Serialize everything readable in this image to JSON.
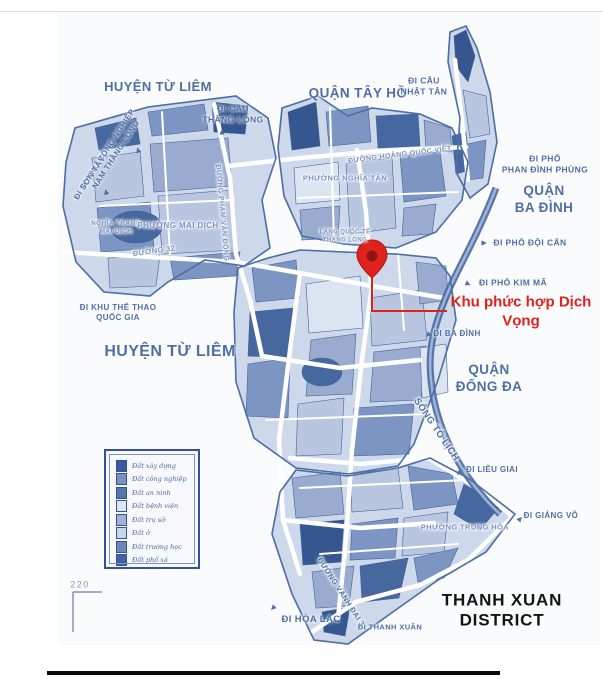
{
  "map": {
    "colors": {
      "label_blue": "#4d6fa6",
      "label_light_blue": "#7b92c0",
      "accent_red": "#df221c",
      "ink_black": "#131313",
      "map_outline": "#4e6fa6",
      "river_blue": "#47679f"
    },
    "highlight": {
      "label": "Khu phức hợp Dịch Vọng",
      "color": "#df221c"
    },
    "scale_label": "220",
    "labels": [
      {
        "name": "label-huyen-tu-liem-top",
        "lines": [
          "HUYỆN TỪ LIÊM"
        ],
        "x": 158,
        "y": 87,
        "fs": 13
      },
      {
        "name": "label-di-cau-thang-long",
        "lines": [
          "ĐI CẦU",
          "THĂNG LONG"
        ],
        "x": 233,
        "y": 114,
        "fs": 8.5
      },
      {
        "name": "label-quan-tay-ho",
        "lines": [
          "QUẬN TÂY HỒ"
        ],
        "x": 358,
        "y": 94,
        "fs": 13.5
      },
      {
        "name": "label-di-cau-nhat-tan",
        "lines": [
          "ĐI CẦU",
          "NHẬT TÂN"
        ],
        "x": 424,
        "y": 86,
        "fs": 8.5
      },
      {
        "name": "label-di-khu-cong-nghiep-nam-thang-long",
        "lines": [
          "ĐI KHU CÔNG NGHIỆP",
          "NAM THĂNG LONG"
        ],
        "x": 112,
        "y": 152,
        "fs": 8,
        "rot": -57
      },
      {
        "name": "label-di-son-tay",
        "lines": [
          "ĐI SƠN TÂY"
        ],
        "x": 90,
        "y": 178,
        "fs": 8,
        "rot": -57
      },
      {
        "name": "label-duong-hoang-quoc-viet",
        "lines": [
          "ĐƯỜNG HOÀNG QUỐC VIỆT"
        ],
        "x": 400,
        "y": 156,
        "fs": 7,
        "rot": -7,
        "cls": "lt halo"
      },
      {
        "name": "label-di-pho-phan-dinh-phung",
        "lines": [
          "ĐI PHỐ",
          "PHAN ĐÌNH PHÙNG"
        ],
        "x": 545,
        "y": 164,
        "fs": 8.5
      },
      {
        "name": "label-quan-ba-dinh",
        "lines": [
          "QUẬN",
          "BA ĐÌNH"
        ],
        "x": 544,
        "y": 200,
        "fs": 13.5
      },
      {
        "name": "label-phuong-nghia-tan",
        "lines": [
          "PHƯỜNG NGHĨA TÂN"
        ],
        "x": 345,
        "y": 178,
        "fs": 7.5,
        "cls": "lt halo"
      },
      {
        "name": "label-nghia-trang-mai-dich",
        "lines": [
          "NGHĨA TRANG",
          "MAI DỊCH"
        ],
        "x": 116,
        "y": 228,
        "fs": 6.5,
        "cls": "lt halo"
      },
      {
        "name": "label-phuong-mai-dich",
        "lines": [
          "PHƯỜNG MAI DỊCH"
        ],
        "x": 178,
        "y": 226,
        "fs": 8,
        "cls": "lt halo"
      },
      {
        "name": "label-duong-32",
        "lines": [
          "ĐƯỜNG 32"
        ],
        "x": 154,
        "y": 251,
        "fs": 7.5,
        "rot": -8,
        "cls": "lt halo"
      },
      {
        "name": "label-duong-pham-van-dong",
        "lines": [
          "ĐƯỜNG PHẠM VĂN ĐỒNG"
        ],
        "x": 221,
        "y": 213,
        "fs": 7,
        "rot": 85,
        "cls": "lt halo"
      },
      {
        "name": "label-lang-quoc-te-thang-long",
        "lines": [
          "LÀNG QUỐC TẾ",
          "THĂNG LONG"
        ],
        "x": 345,
        "y": 237,
        "fs": 6,
        "cls": "lt halo"
      },
      {
        "name": "label-di-pho-doi-can",
        "lines": [
          "ĐI PHỐ ĐỘI CẤN"
        ],
        "x": 530,
        "y": 243,
        "fs": 8.5
      },
      {
        "name": "label-di-pho-kim-ma",
        "lines": [
          "ĐI PHỐ KIM MÃ"
        ],
        "x": 513,
        "y": 283,
        "fs": 8.5
      },
      {
        "name": "label-di-khu-the-thao-quoc-gia",
        "lines": [
          "ĐI KHU THỂ THAO",
          "QUỐC GIA"
        ],
        "x": 118,
        "y": 313,
        "fs": 8
      },
      {
        "name": "label-huyen-tu-liem",
        "lines": [
          "HUYỆN TỪ LIÊM"
        ],
        "x": 170,
        "y": 352,
        "fs": 16
      },
      {
        "name": "label-di-ba-dinh",
        "lines": [
          "ĐI BA ĐÌNH"
        ],
        "x": 457,
        "y": 334,
        "fs": 8
      },
      {
        "name": "label-quan-dong-da",
        "lines": [
          "QUẬN",
          "ĐỐNG ĐA"
        ],
        "x": 489,
        "y": 379,
        "fs": 13.5
      },
      {
        "name": "label-song-to-lich",
        "lines": [
          "SÔNG TÔ LỊCH"
        ],
        "x": 436,
        "y": 430,
        "fs": 9.5,
        "rot": 56,
        "cls": "halo"
      },
      {
        "name": "label-di-lieu-giai",
        "lines": [
          "ĐI LIỄU GIAI"
        ],
        "x": 492,
        "y": 470,
        "fs": 8
      },
      {
        "name": "label-di-giang-vo",
        "lines": [
          "ĐI GIẢNG VÕ"
        ],
        "x": 551,
        "y": 516,
        "fs": 8
      },
      {
        "name": "label-phuong-trung-hoa",
        "lines": [
          "PHƯỜNG TRUNG HÒA"
        ],
        "x": 465,
        "y": 527,
        "fs": 7.5,
        "cls": "lt halo"
      },
      {
        "name": "label-duong-vanh-dai-3",
        "lines": [
          "ĐƯỜNG VÀNH ĐAI 3"
        ],
        "x": 341,
        "y": 592,
        "fs": 7.5,
        "rot": 57,
        "cls": "halo"
      },
      {
        "name": "label-di-hoa-lac",
        "lines": [
          "ĐI HÒA LẠC"
        ],
        "x": 311,
        "y": 620,
        "fs": 9.5
      },
      {
        "name": "label-di-thanh-xuan",
        "lines": [
          "ĐI THANH XUÂN"
        ],
        "x": 390,
        "y": 627,
        "fs": 7.5
      },
      {
        "name": "label-thanh-xuan-district",
        "lines": [
          "THANH XUAN",
          "DISTRICT"
        ],
        "x": 502,
        "y": 610,
        "fs": 17,
        "cls": "black"
      },
      {
        "name": "label-khu-phuc-hop-dich-vong",
        "lines": [
          "Khu phức hợp Dịch",
          "Vọng"
        ],
        "x": 521,
        "y": 312,
        "fs": 15,
        "cls": "red"
      },
      {
        "name": "label-scale-220",
        "lines": [
          "220"
        ],
        "x": 80,
        "y": 585,
        "fs": 9,
        "cls": "scale"
      }
    ],
    "arrows": [
      {
        "name": "arrow-di-cau-thang-long",
        "x": 222,
        "y": 132,
        "rot": 0
      },
      {
        "name": "arrow-di-khu-cong-nghiep",
        "x": 138,
        "y": 150,
        "rot": -15
      },
      {
        "name": "arrow-di-son-tay",
        "x": 106,
        "y": 192,
        "rot": -15
      },
      {
        "name": "arrow-di-pho-doi-can",
        "x": 484,
        "y": 243,
        "rot": 90
      },
      {
        "name": "arrow-di-pho-kim-ma",
        "x": 468,
        "y": 284,
        "rot": 115
      },
      {
        "name": "arrow-di-ba-dinh",
        "x": 428,
        "y": 335,
        "rot": 225
      },
      {
        "name": "arrow-di-lieu-giai",
        "x": 459,
        "y": 473,
        "rot": 225
      },
      {
        "name": "arrow-di-giang-vo",
        "x": 520,
        "y": 519,
        "rot": 40
      },
      {
        "name": "arrow-di-hoa-lac",
        "x": 273,
        "y": 608,
        "rot": 225
      }
    ],
    "legend": {
      "items": [
        {
          "label": "Đất xây dựng",
          "color": "#3a5a9e"
        },
        {
          "label": "Đất công nghiệp",
          "color": "#7b92c0"
        },
        {
          "label": "Đất an ninh",
          "color": "#5874ab"
        },
        {
          "label": "Đất bệnh viện",
          "color": "#dfe6f2"
        },
        {
          "label": "Đất trụ sở",
          "color": "#9fb2d4"
        },
        {
          "label": "Đất ở",
          "color": "#ccd6ea"
        },
        {
          "label": "Đất trường học",
          "color": "#6c86b8"
        },
        {
          "label": "Đất phố xá",
          "color": "#41619f"
        }
      ]
    }
  }
}
